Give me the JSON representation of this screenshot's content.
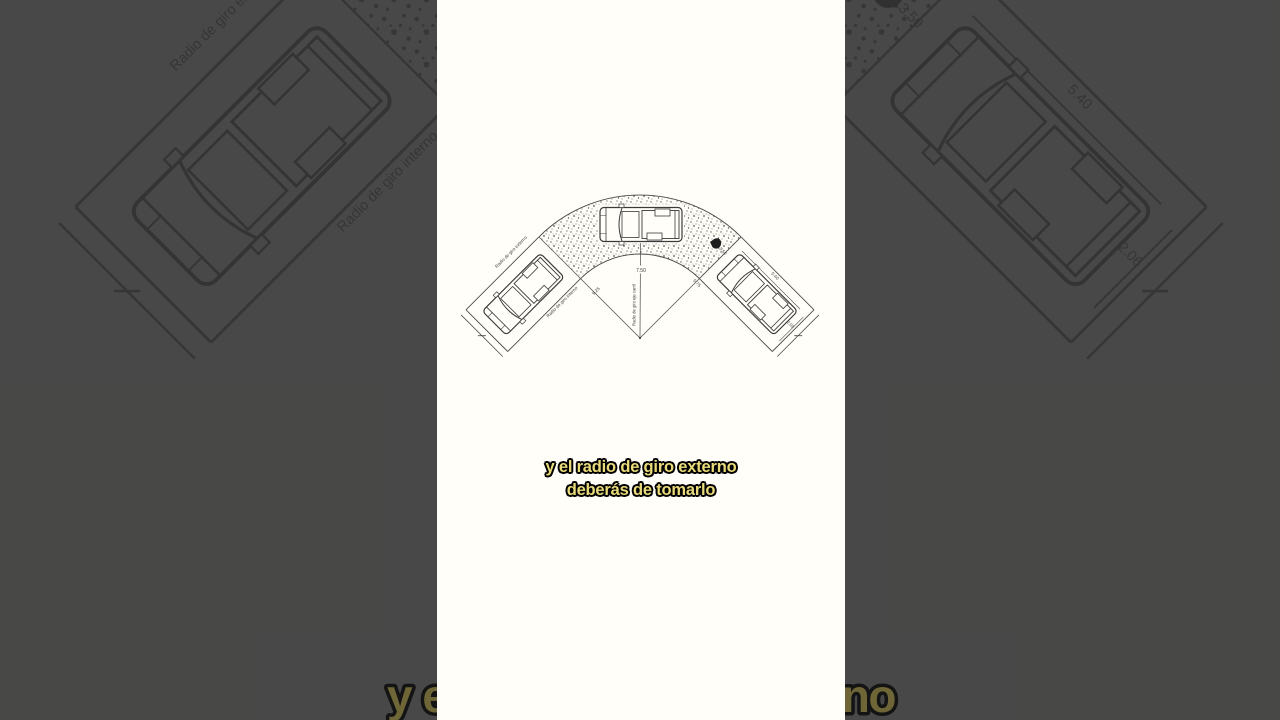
{
  "frame": {
    "background_color": "#4c4c4c",
    "paper_color": "#fffef8"
  },
  "captions": {
    "line1": "y el radio de giro externo",
    "line2": "deberás de tomarlo",
    "text_color": "#eadb7a"
  },
  "background_caption": {
    "text": "y el radio de giro externo",
    "visible_left_fragment": "y el r",
    "visible_right_fragment": "erno",
    "text_color": "#6f6637"
  },
  "diagram": {
    "labels": {
      "outer_radius_text": "Radio de giro externo",
      "inner_radius_text": "Radio de giro interno",
      "axis_radius_text": "Radio de giro eje carril",
      "axis_radius_value": "7.50",
      "outer_radius_value": "9.25",
      "inner_radius_value": "5.75",
      "lane_width_value": "3.50",
      "vehicle_length_value": "5.40",
      "vehicle_width_value": "2.06"
    }
  }
}
